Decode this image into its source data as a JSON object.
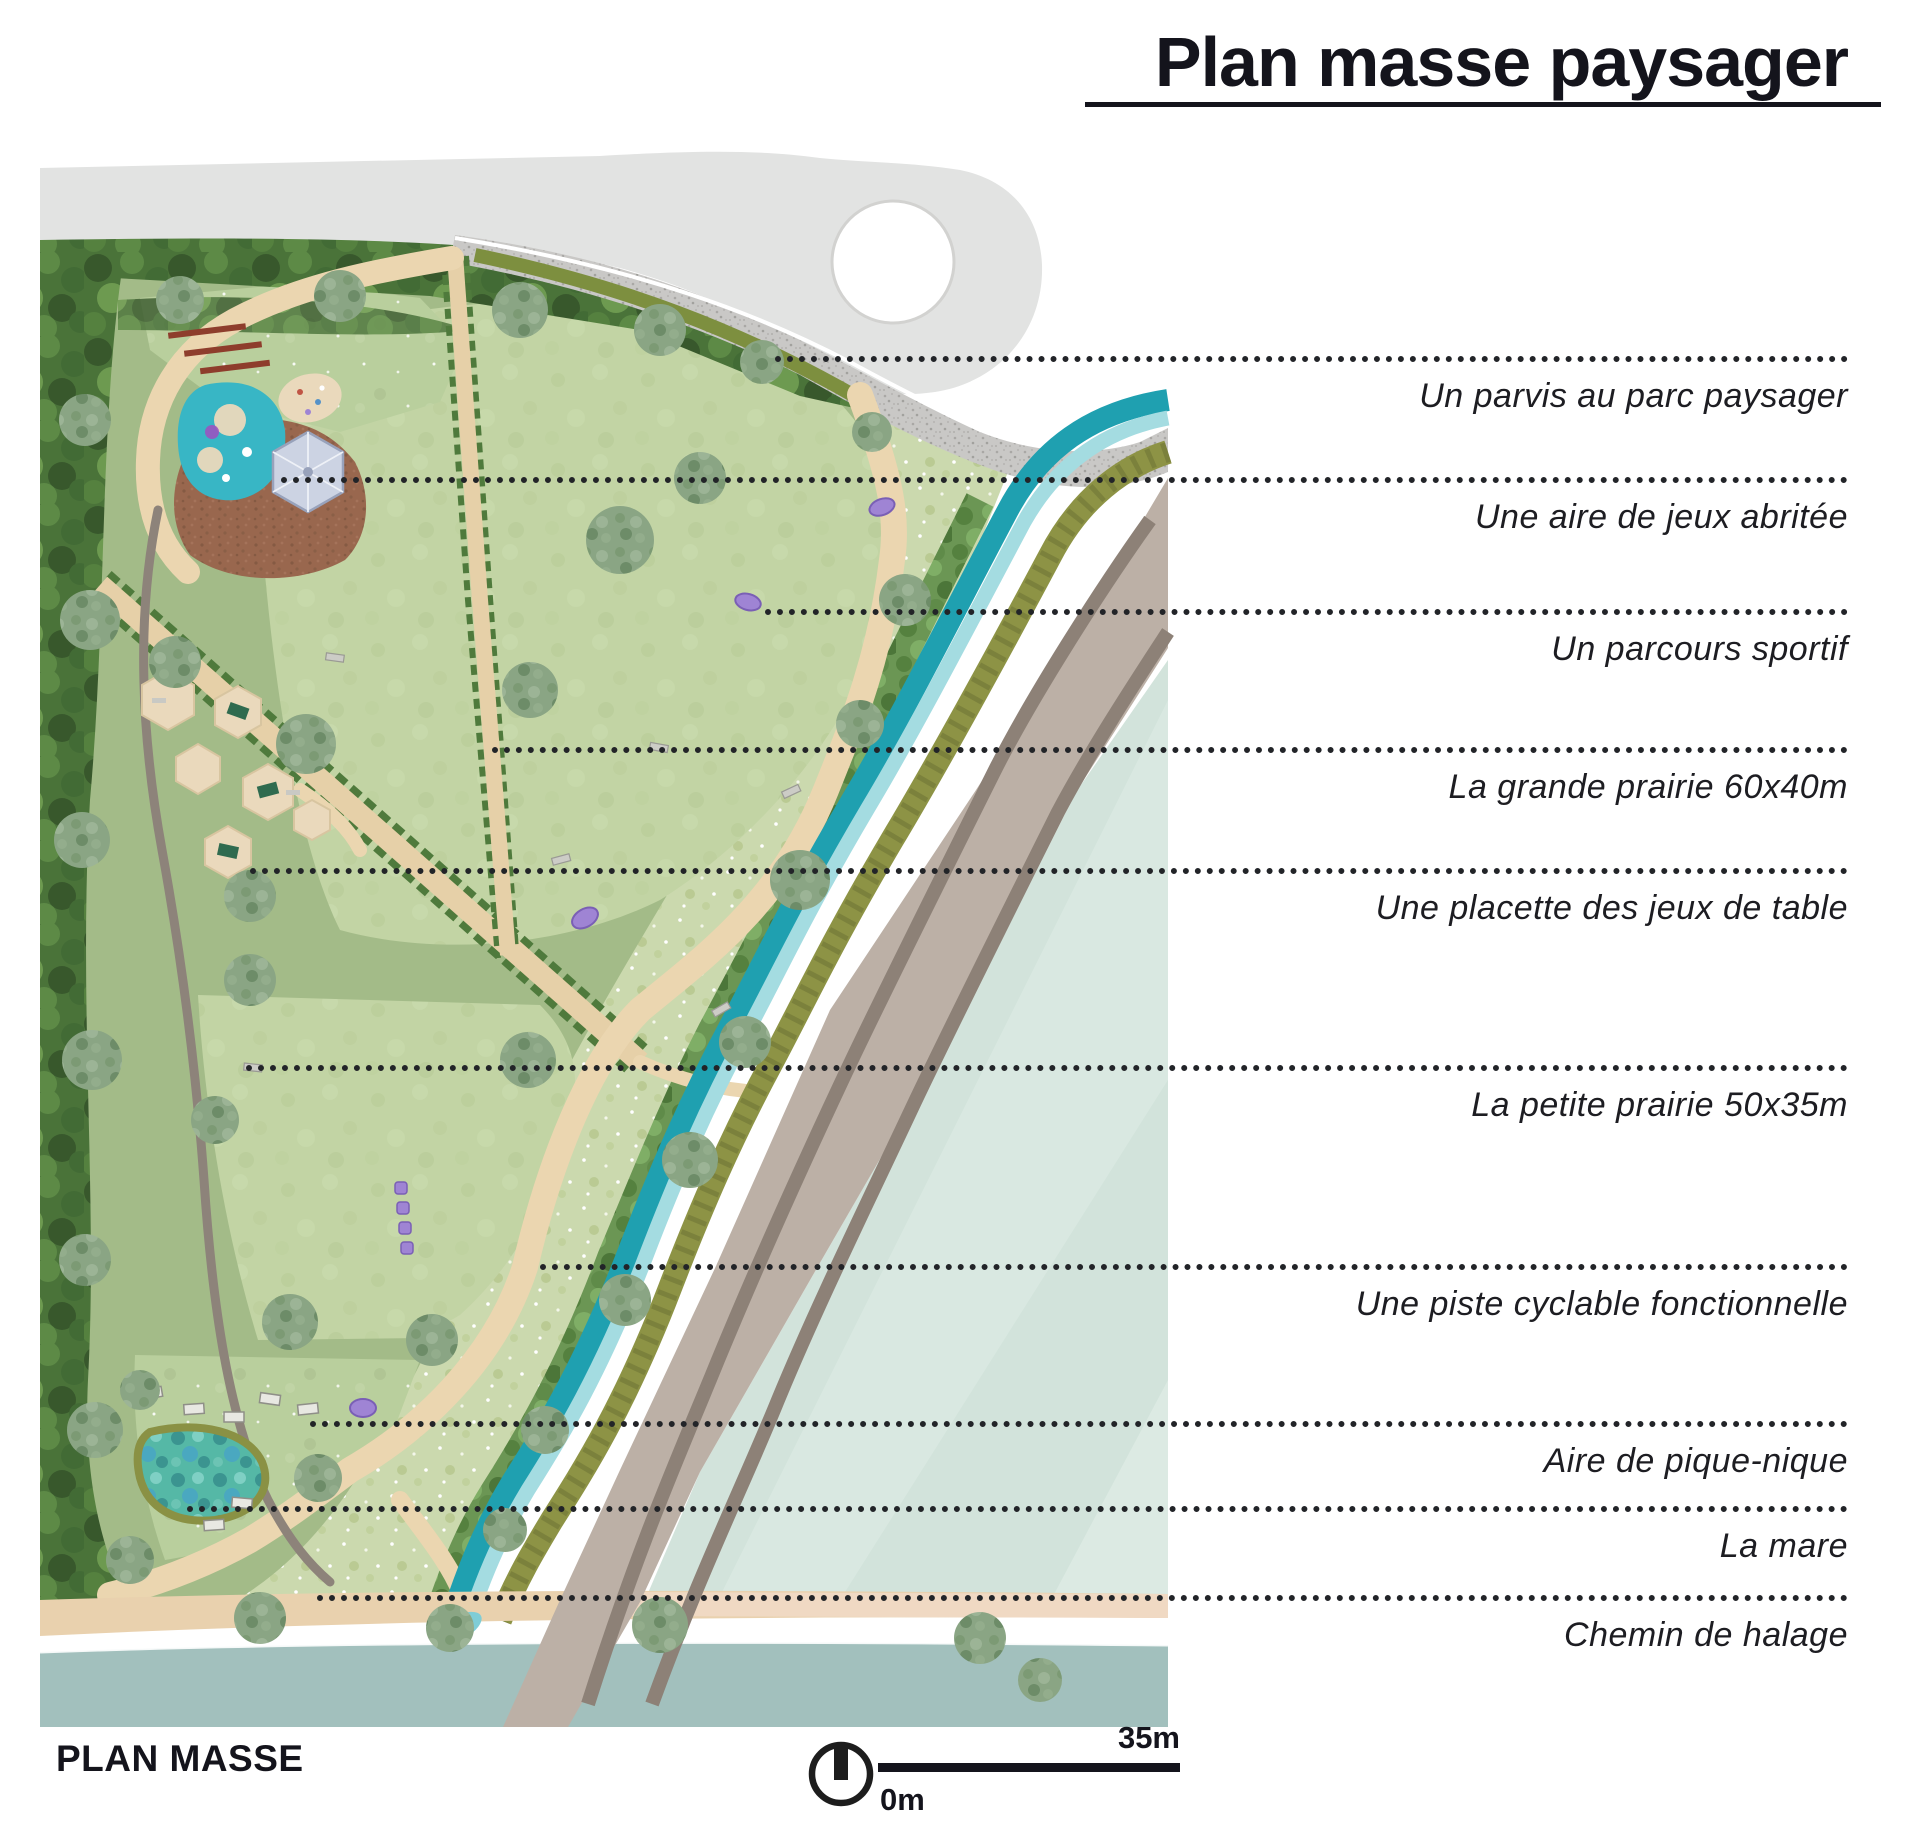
{
  "title": "Plan masse paysager",
  "annotations": [
    {
      "label": "Un parvis au parc paysager"
    },
    {
      "label": "Une aire de jeux abritée"
    },
    {
      "label": "Un parcours sportif"
    },
    {
      "label": "La grande prairie  60x40m"
    },
    {
      "label": "Une placette des jeux de table"
    },
    {
      "label": "La petite prairie 50x35m"
    },
    {
      "label": "Une piste cyclable fonctionnelle"
    },
    {
      "label": "Aire de pique-nique"
    },
    {
      "label": "La mare"
    },
    {
      "label": "Chemin de halage"
    }
  ],
  "footer": {
    "plan_label": "PLAN MASSE",
    "scale_start": "0m",
    "scale_end": "35m",
    "north_icon": "north-arrow-icon"
  },
  "palette": {
    "ink": "#14141c",
    "road_top_gray": "#e2e3e2",
    "gravel_parvis": "#c9c8c6",
    "forest_green": "#4a7339",
    "park_green": "#a3bb88",
    "prairie_green": "#c2d4a4",
    "path_beige": "#ebd6b0",
    "canal_teal_dark": "#1fa0b0",
    "canal_teal_light": "#a4dce1",
    "hedge_olive": "#8d9345",
    "cycle_road_taupe": "#bcb0a6",
    "cycle_road_stripe": "#8d8177",
    "riverside_pale": "#d2e3db",
    "towpath_peach": "#f0d9c3",
    "river_water": "#a2c0bd",
    "playground_plaza": "#99674e",
    "pool_teal": "#38b6c5",
    "furniture_purple": "#9f84d4",
    "table_green": "#2f6b4f",
    "bench_red": "#8e3d2c"
  },
  "plan_features": [
    {
      "name": "parvis",
      "color": "#c9c8c6"
    },
    {
      "name": "aire-de-jeux",
      "color": "#99674e"
    },
    {
      "name": "parcours-sportif",
      "color": "#9f84d4"
    },
    {
      "name": "grande-prairie",
      "color": "#c2d4a4"
    },
    {
      "name": "placette-jeux-de-table",
      "color": "#ead9bc"
    },
    {
      "name": "petite-prairie",
      "color": "#c2d4a4"
    },
    {
      "name": "piste-cyclable",
      "color": "#bcb0a6"
    },
    {
      "name": "aire-de-pique-nique",
      "color": "#b9cf9d"
    },
    {
      "name": "la-mare",
      "color": "#55b8a6"
    },
    {
      "name": "chemin-de-halage",
      "color": "#e9d1ae"
    },
    {
      "name": "canal",
      "color": "#1fa0b0"
    },
    {
      "name": "riviere",
      "color": "#a2c0bd"
    }
  ]
}
